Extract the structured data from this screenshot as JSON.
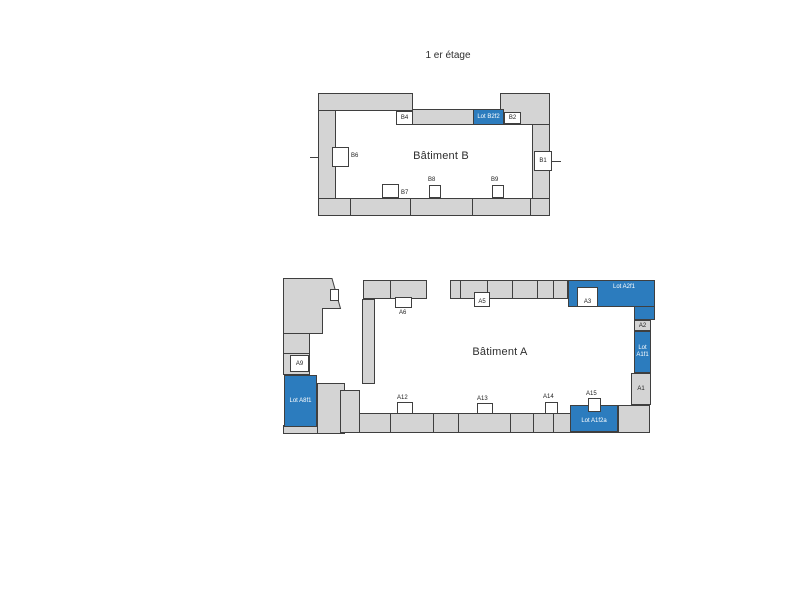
{
  "title": "1 er étage",
  "colors": {
    "wall_fill": "#d4d4d4",
    "outline": "#3f3f3f",
    "lot_blue": "#2c7cbe",
    "label_text": "#1e1e1e"
  },
  "building_b": {
    "name": "Bâtiment B",
    "rooms": {
      "b1": "B1",
      "b2": "B2",
      "b4": "B4",
      "b6": "B6",
      "b7": "B7",
      "b8": "B8",
      "b9": "B9"
    },
    "lots": {
      "b2f2": "Lot B2f2"
    }
  },
  "building_a": {
    "name": "Bâtiment A",
    "rooms": {
      "a1": "A1",
      "a2": "A2",
      "a3": "A3",
      "a5": "A5",
      "a6": "A6",
      "a9": "A9",
      "a12": "A12",
      "a13": "A13",
      "a14": "A14",
      "a15": "A15"
    },
    "lots": {
      "a2f1": "Lot A2f1",
      "a1f1": "Lot A1f1",
      "a1f2a": "Lot A1f2a",
      "a8f1": "Lot A8f1"
    }
  }
}
